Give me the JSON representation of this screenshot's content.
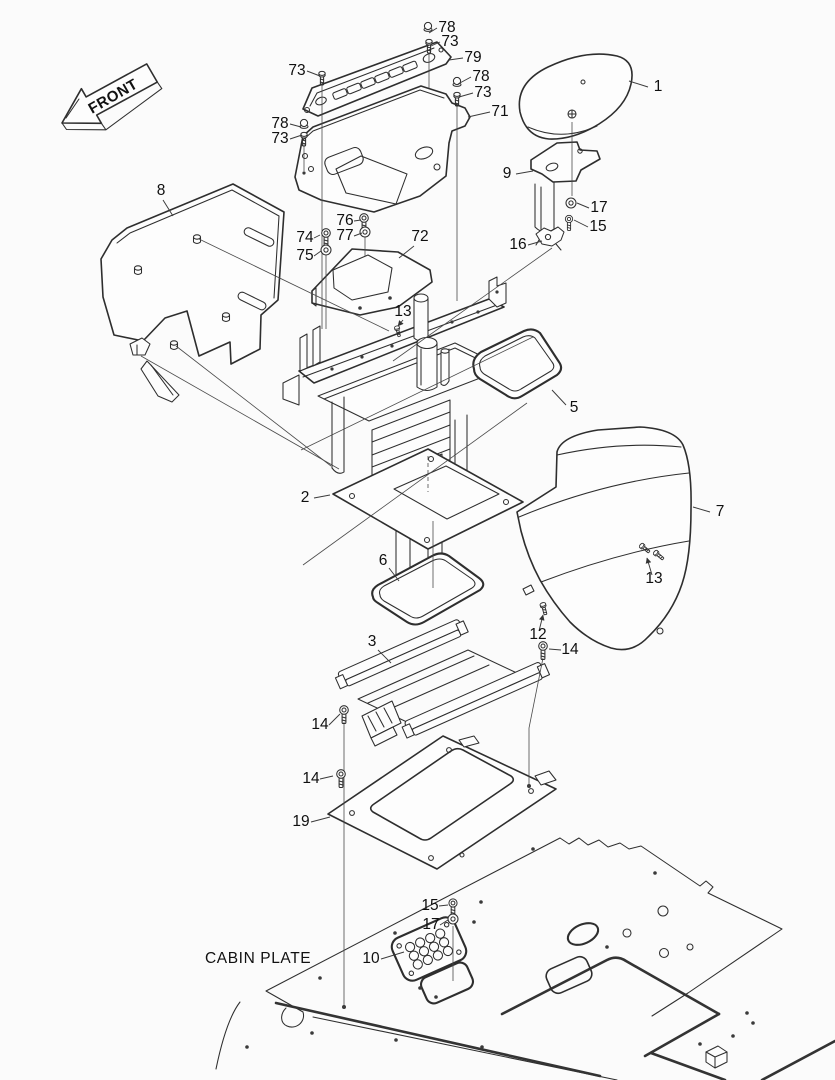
{
  "labels": {
    "front": "FRONT",
    "cabin_plate": "CABIN PLATE"
  },
  "callouts": [
    {
      "label": "78"
    },
    {
      "label": "73"
    },
    {
      "label": "79"
    },
    {
      "label": "73"
    },
    {
      "label": "78"
    },
    {
      "label": "73"
    },
    {
      "label": "71"
    },
    {
      "label": "78"
    },
    {
      "label": "73"
    },
    {
      "label": "8"
    },
    {
      "label": "1"
    },
    {
      "label": "9"
    },
    {
      "label": "17"
    },
    {
      "label": "15"
    },
    {
      "label": "16"
    },
    {
      "label": "76"
    },
    {
      "label": "77"
    },
    {
      "label": "74"
    },
    {
      "label": "75"
    },
    {
      "label": "72"
    },
    {
      "label": "13"
    },
    {
      "label": "5"
    },
    {
      "label": "2"
    },
    {
      "label": "7"
    },
    {
      "label": "13"
    },
    {
      "label": "6"
    },
    {
      "label": "12"
    },
    {
      "label": "3"
    },
    {
      "label": "14"
    },
    {
      "label": "14"
    },
    {
      "label": "14"
    },
    {
      "label": "19"
    },
    {
      "label": "15"
    },
    {
      "label": "17"
    },
    {
      "label": "10"
    }
  ],
  "style": {
    "line_color": "#2e2e2e",
    "text_color": "#101010",
    "background": "#fbfbfb"
  }
}
